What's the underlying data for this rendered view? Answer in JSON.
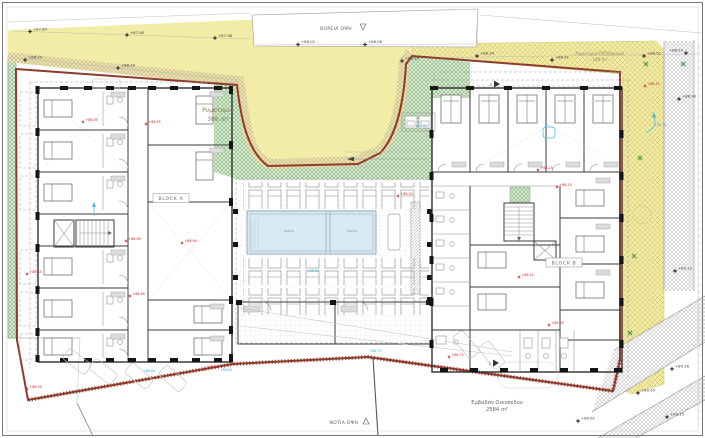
{
  "plan": {
    "labels": {
      "road_top_name": "Ρυμοτομια",
      "road_top_area": "388 m²",
      "road_right_name": "Ρυμοτομια-Πεζόδρομος",
      "road_right_area": "149 m²",
      "north_view": "ΒΟΡΕΙΑ ΟΨΗ",
      "south_view": "ΝΟΤΙΑ ΟΨΗ",
      "block_a": "BLOCK A",
      "block_b": "BLOCK B",
      "plot_label": "Εμβαδόν Οικοπέδου",
      "plot_area": "2584 m²",
      "pool_left": "Πισίνα",
      "pool_right": "Πισίνα",
      "section_marks": [
        "2",
        "2"
      ]
    },
    "elev_black": [
      {
        "v": "+87.84"
      },
      {
        "v": "+87.90"
      },
      {
        "v": "+87.98"
      },
      {
        "v": "+88.02"
      },
      {
        "v": "+88.08"
      },
      {
        "v": "+88.25"
      },
      {
        "v": "+88.04"
      },
      {
        "v": "+88.10"
      },
      {
        "v": "+88.34"
      },
      {
        "v": "+88.41"
      },
      {
        "v": "+88.51"
      },
      {
        "v": "+88.55"
      },
      {
        "v": "+88.90"
      },
      {
        "v": "+89.12"
      },
      {
        "v": "+89.26"
      },
      {
        "v": "+89.45"
      },
      {
        "v": "+89.15"
      },
      {
        "v": "+89.61"
      }
    ],
    "elev_red": [
      {
        "v": "+86.95"
      },
      {
        "v": "+86.95"
      },
      {
        "v": "+86.90"
      },
      {
        "v": "+86.90"
      },
      {
        "v": "+86.85"
      },
      {
        "v": "+86.90"
      },
      {
        "v": "+88.95"
      },
      {
        "v": "+88.60"
      },
      {
        "v": "+88.20"
      },
      {
        "v": "+88.25"
      },
      {
        "v": "+88.25"
      },
      {
        "v": "+88.15"
      },
      {
        "v": "+88.17"
      },
      {
        "v": "+89.05"
      },
      {
        "v": "+88.75"
      }
    ],
    "elev_blue": [
      {
        "v": "+87.37"
      },
      {
        "v": "+88.20"
      },
      {
        "v": "+88.75"
      },
      {
        "v": "+88.60"
      },
      {
        "v": "+88.30"
      },
      {
        "v": "+88.60"
      }
    ],
    "colors": {
      "road_yellow": "#f2eda6",
      "road_hatch": "#cfc06d",
      "strip_khaki": "#b9a767",
      "landscape_green": "#79b079",
      "boundary_red": "#8e3b2b",
      "pool_blue": "#d8e9f3",
      "marker_black": "#3c3c3c",
      "marker_red": "#c32222",
      "marker_blue": "#45b8d6"
    }
  }
}
